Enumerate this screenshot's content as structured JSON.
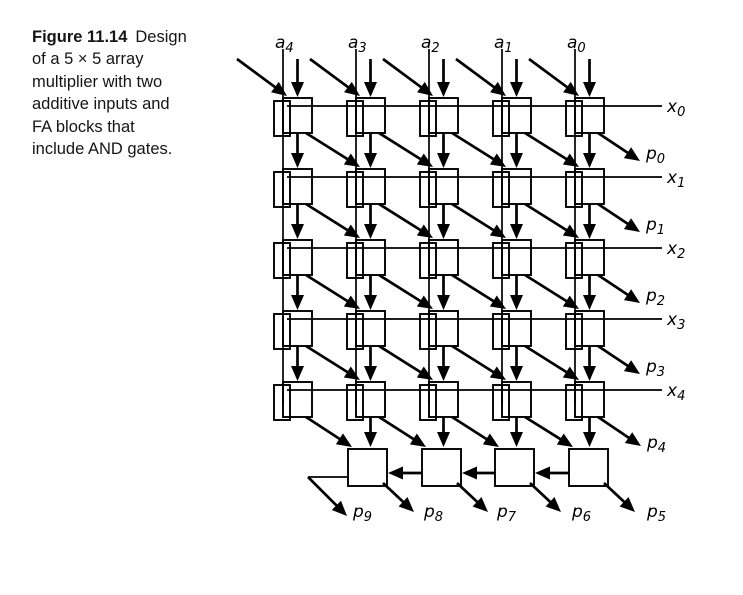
{
  "caption": {
    "title": "Figure 11.14",
    "line1_rest": "Design",
    "lines": [
      "of a 5 × 5 array",
      "multiplier with two",
      "additive inputs and",
      "FA blocks that",
      "include AND gates."
    ]
  },
  "labels": {
    "a": [
      {
        "base": "a",
        "sub": "4"
      },
      {
        "base": "a",
        "sub": "3"
      },
      {
        "base": "a",
        "sub": "2"
      },
      {
        "base": "a",
        "sub": "1"
      },
      {
        "base": "a",
        "sub": "0"
      }
    ],
    "x": [
      {
        "base": "x",
        "sub": "0"
      },
      {
        "base": "x",
        "sub": "1"
      },
      {
        "base": "x",
        "sub": "2"
      },
      {
        "base": "x",
        "sub": "3"
      },
      {
        "base": "x",
        "sub": "4"
      }
    ],
    "p_right": [
      {
        "base": "p",
        "sub": "0"
      },
      {
        "base": "p",
        "sub": "1"
      },
      {
        "base": "p",
        "sub": "2"
      },
      {
        "base": "p",
        "sub": "3"
      },
      {
        "base": "p",
        "sub": "4"
      }
    ],
    "p_bottom": [
      {
        "base": "p",
        "sub": "9"
      },
      {
        "base": "p",
        "sub": "8"
      },
      {
        "base": "p",
        "sub": "7"
      },
      {
        "base": "p",
        "sub": "6"
      },
      {
        "base": "p",
        "sub": "5"
      }
    ]
  },
  "colors": {
    "ink": "#000000",
    "background": "#ffffff"
  }
}
